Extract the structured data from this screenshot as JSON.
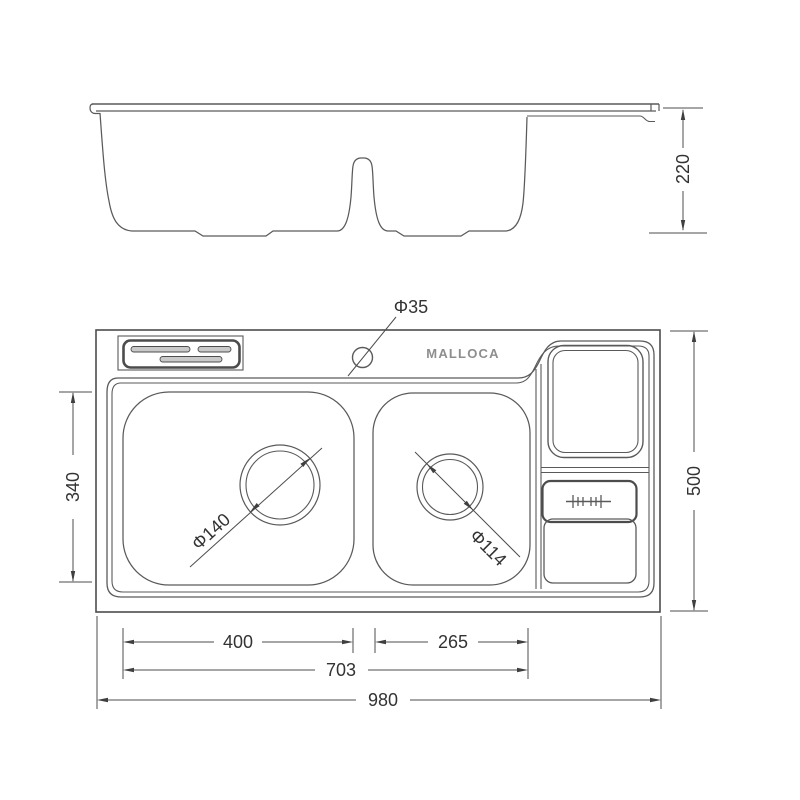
{
  "drawing": {
    "brand": "MALLOCA",
    "labels": {
      "side_height": "220",
      "faucet_hole": "Φ35",
      "left_drain": "Φ140",
      "right_drain": "Φ114",
      "bowl_inner_depth": "340",
      "overall_depth": "500",
      "left_bowl_width": "400",
      "right_bowl_width": "265",
      "bowls_outer_span": "703",
      "overall_width": "980"
    }
  }
}
